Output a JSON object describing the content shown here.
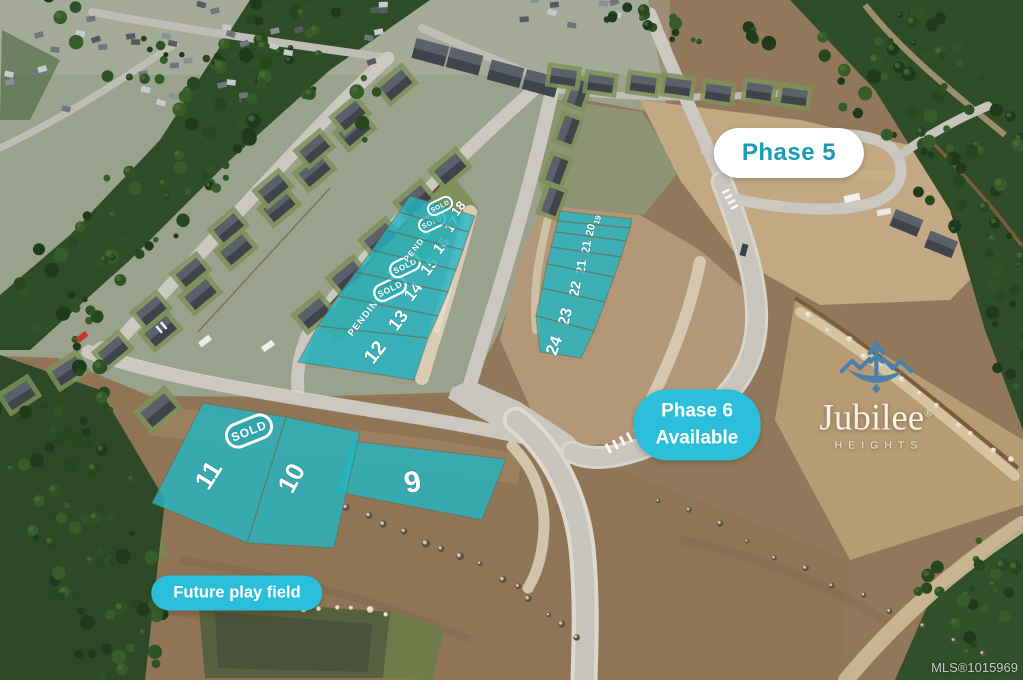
{
  "overlays": {
    "phase5": {
      "label": "Phase 5"
    },
    "phase6": {
      "line1": "Phase 6",
      "line2": "Available"
    },
    "future_field": {
      "label": "Future play field"
    },
    "logo": {
      "wordmark": "Jubilee",
      "registered": "®",
      "subtitle": "HEIGHTS"
    },
    "watermark": {
      "label": "MLS®1015969"
    },
    "colors": {
      "pill_teal": "#2bbfdb",
      "phase5_text": "#1a9cb5",
      "lot_teal": "#25b4c2",
      "label_white": "#ffffff"
    },
    "lots": [
      {
        "id": "9",
        "number": "9",
        "status": null
      },
      {
        "id": "10",
        "number": "10",
        "status": null
      },
      {
        "id": "11",
        "number": "11",
        "status": "SOLD",
        "status_style": "badge"
      },
      {
        "id": "12",
        "number": "12",
        "status": null
      },
      {
        "id": "13",
        "number": "13",
        "status": "PENDING",
        "status_style": "text"
      },
      {
        "id": "14",
        "number": "14",
        "status": "SOLD",
        "status_style": "badge"
      },
      {
        "id": "15",
        "number": "15",
        "status": "SOLD",
        "status_style": "badge"
      },
      {
        "id": "16",
        "number": "16",
        "status": "PENDING",
        "status_style": "text"
      },
      {
        "id": "17",
        "number": "17",
        "status": "SOLD",
        "status_style": "badge"
      },
      {
        "id": "18",
        "number": "18",
        "status": "SOLD",
        "status_style": "badge"
      },
      {
        "id": "19",
        "number": "19",
        "status": null
      },
      {
        "id": "20",
        "number": "20",
        "status": null
      },
      {
        "id": "21a",
        "number": "21",
        "status": null
      },
      {
        "id": "21b",
        "number": "21",
        "status": null
      },
      {
        "id": "22",
        "number": "22",
        "status": null
      },
      {
        "id": "23",
        "number": "23",
        "status": null
      },
      {
        "id": "24",
        "number": "24",
        "status": null
      }
    ]
  }
}
